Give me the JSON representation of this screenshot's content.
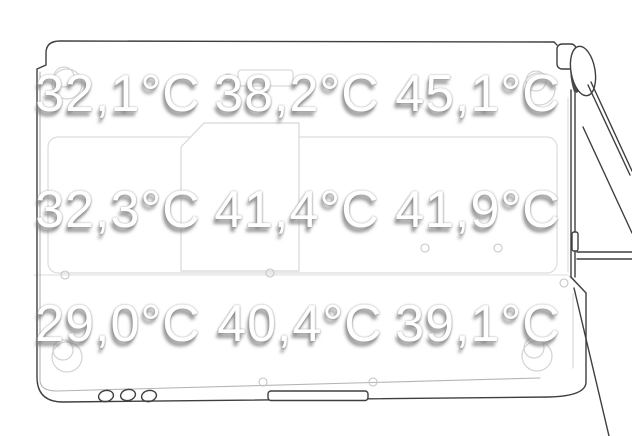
{
  "chart_data": {
    "type": "heatmap",
    "title": "",
    "unit": "°C",
    "decimal_separator": ",",
    "grid": {
      "rows": 3,
      "cols": 3
    },
    "values": [
      [
        32.1,
        38.2,
        45.1
      ],
      [
        32.3,
        41.4,
        41.9
      ],
      [
        29.0,
        40.4,
        39.1
      ]
    ],
    "labels": [
      [
        "32,1°C",
        "38,2°C",
        "45,1°C"
      ],
      [
        "32,3°C",
        "41,4°C",
        "41,9°C"
      ],
      [
        "29,0°C",
        "40,4°C",
        "39,1°C"
      ]
    ]
  },
  "drawing": {
    "name": "laptop-bottom-outline-with-open-lid"
  },
  "colors": {
    "background": "#ffffff",
    "line_dark": "#3f3f3f",
    "line_light": "#d9d9d9",
    "label_text": "#ffffff",
    "label_shadow": "#828282"
  }
}
